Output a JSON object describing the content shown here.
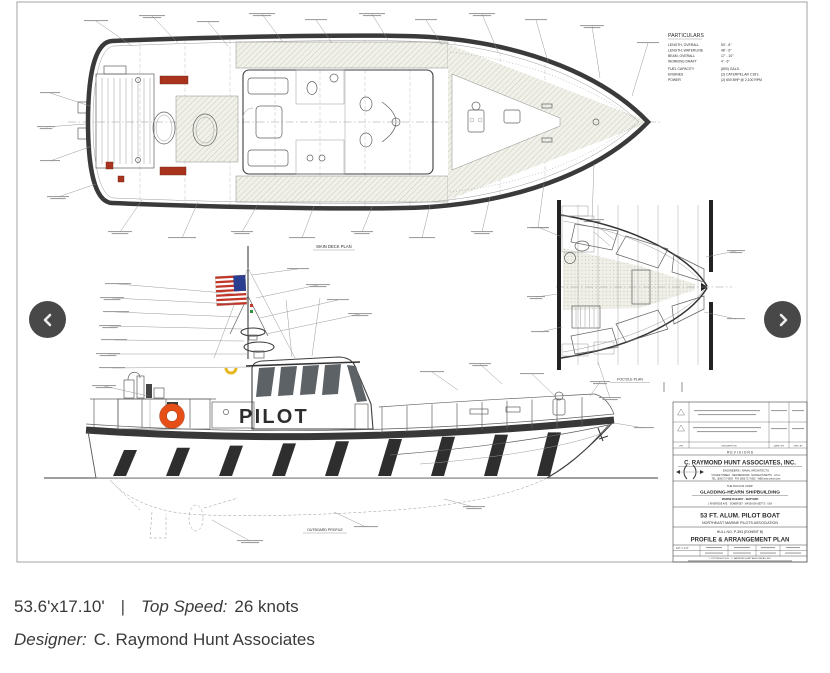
{
  "caption": {
    "size": "53.6'x17.10'",
    "divider": "|",
    "top_speed_label": "Top Speed:",
    "top_speed_value": "26 knots",
    "designer_label": "Designer:",
    "designer_value": "C. Raymond Hunt Associates"
  },
  "carousel": {
    "prev_icon": "chevron-left",
    "next_icon": "chevron-right"
  },
  "sheet": {
    "hull_text": "PILOT",
    "plan_labels": {
      "main_deck": "MAIN DECK PLAN",
      "outboard": "OUTBOARD PROFILE",
      "focsle": "FOC'S'LE PLAN"
    },
    "particulars": {
      "title": "PARTICULARS",
      "rows": [
        {
          "k": "LENGTH, OVERALL",
          "v": "53' - 6\""
        },
        {
          "k": "LENGTH, WATERLINE",
          "v": "48' - 6\""
        },
        {
          "k": "BEAM, OVERALL",
          "v": "17' - 10\""
        },
        {
          "k": "WORKING DRAFT",
          "v": "4' - 6\""
        },
        {
          "k": "FUEL CAPACITY",
          "v": "(800) GALS."
        },
        {
          "k": "ENGINES",
          "v": "(2) CATERPILLAR C18's"
        },
        {
          "k": "POWER",
          "v": "(2) 600 BHP @ 2,100 RPM"
        }
      ]
    },
    "title_block": {
      "revisions_header": "R E V I S I O N S",
      "rev_columns": [
        "LTR.",
        "DESCRIPTION",
        "DATE / BY",
        "CHK / BY"
      ],
      "company": "C. RAYMOND HUNT ASSOCIATES, INC.",
      "company_type": "ENGINEERS / NAVAL ARCHITECTS",
      "company_address": "5 RIVER STREET · NEW BEDFORD · MASSACHUSETTS · U.S.A.",
      "company_contact": "TEL. (508) 717-0600 · FAX (508) 717-0602 · WEB www.crhunt.com",
      "builder_intro": "THE DUCLOS CORP.",
      "builder": "GLADDING-HEARN SHIPBUILDING",
      "builder_type": "MARINE RAILWAY · SHIPYARD",
      "builder_address": "1 RIVERSIDE AVE. · SOMERSET · MASSACHUSETTS · USA",
      "project": "53 FT. ALUM. PILOT BOAT",
      "client": "NORTHEAST MARINE PILOTS ASSOCIATION",
      "hull_no": "HULL NO. P-393 (EXHIBIT B)",
      "sheet_title": "PROFILE & ARRANGEMENT PLAN",
      "scale": "1/2\" = 1'-0\"",
      "copyright": "© COPYRIGHT 2011 · C. RAYMOND HUNT ASSOCIATES, INC."
    }
  },
  "colors": {
    "accent_red": "#e01f10",
    "ring_orange": "#e64e17",
    "ink": "#2d2d2d"
  }
}
